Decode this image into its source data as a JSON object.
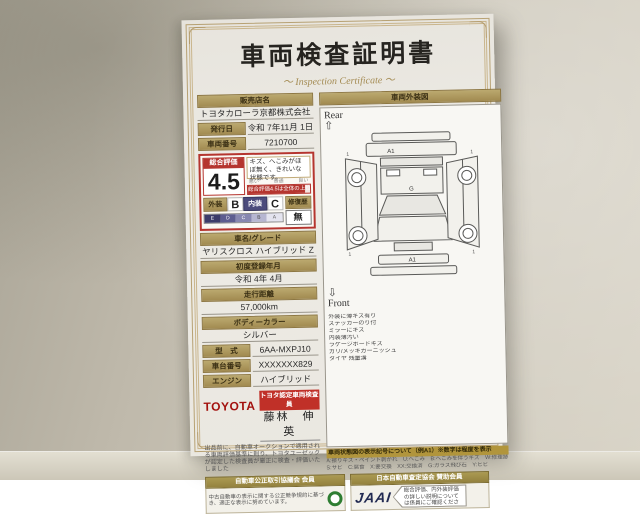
{
  "certificate": {
    "title": "車両検査証明書",
    "subtitle": "～ Inspection Certificate ～",
    "dealer_label": "販売店名",
    "dealer_value": "トヨタカローラ京都株式会社",
    "issue_label": "発行日",
    "issue_value": "令和 7年11月 1日",
    "number_label": "車両番号",
    "number_value": "7210700",
    "rating": {
      "label": "総合評価",
      "score": "4.5",
      "comment": "キズ、へこみがほぼ無く、きれいな状態です。",
      "scale_left": "悪い",
      "scale_mid": "普通",
      "scale_right": "良い",
      "gauge_text": "総合評価4.5は全体の上位約1%内",
      "exterior_label": "外装",
      "exterior_grade": "B",
      "interior_label": "内装",
      "interior_grade": "C",
      "repair_label": "修復歴",
      "repair_value": "無",
      "grade_scale": [
        "E",
        "D",
        "C",
        "B",
        "A"
      ]
    },
    "fields": {
      "model_label": "車名/グレード",
      "model_value": "ヤリスクロス ハイブリッド Z",
      "first_reg_label": "初度登録年月",
      "first_reg_value": "令和 4年 4月",
      "mileage_label": "走行距離",
      "mileage_value": "57,000km",
      "color_label": "ボディーカラー",
      "color_value": "シルバー",
      "type_label": "型　式",
      "type_value": "6AA-MXPJ10",
      "chassis_label": "車台番号",
      "chassis_value": "XXXXXXX829",
      "engine_label": "エンジン",
      "engine_value": "ハイブリッド"
    },
    "inspector": {
      "brand": "TOYOTA",
      "badge": "トヨタ認定車両検査員",
      "name": "藤林　伸英",
      "note": "出品前に、自動車オークションで適用される車両評価基準に則り、トヨタユーゼックが認定した検査員が厳正に検査・評価いたしました"
    },
    "diagram": {
      "header": "車両外装図",
      "rear_label": "Rear",
      "rear_arrow": "⇧",
      "front_label": "Front",
      "front_arrow": "⇩",
      "mark_rear_bumper": "A1",
      "mark_roof": "G",
      "mark_front_bumper": "A1",
      "legend_lines": [
        "外装に薄キズ有り",
        "ステッカーのり付",
        "ミラーにキズ",
        "内装薄汚い",
        "ラゲージボードキズ",
        "ガリ/メッキガーニッシュ",
        "タイヤ 残量溝"
      ]
    },
    "symbol_note": {
      "header": "車両状態図の表示記号について（例A1）※数字は程度を表示",
      "line1": "A:擦りキズ・ペイント剥がれ　U:へこみ　B:へこみを伴うキズ　W:修理跡",
      "line2": "S:サビ　C:腐食　X:要交換　XX:交換済　G:ガラス飛び石　Y:ヒビ"
    },
    "footer": {
      "fair_trade_title": "自動車公正取引協議会 会員",
      "fair_trade_note": "中古自動車の表示に関する公正競争規約に基づき、適正な表示に努めています。",
      "jaai_title": "日本自動車査定協会 賛助会員",
      "jaai_logo": "JAAI",
      "jaai_note": "総合評価、内外装評価の詳しい説明については係員にご確認ください。"
    }
  }
}
